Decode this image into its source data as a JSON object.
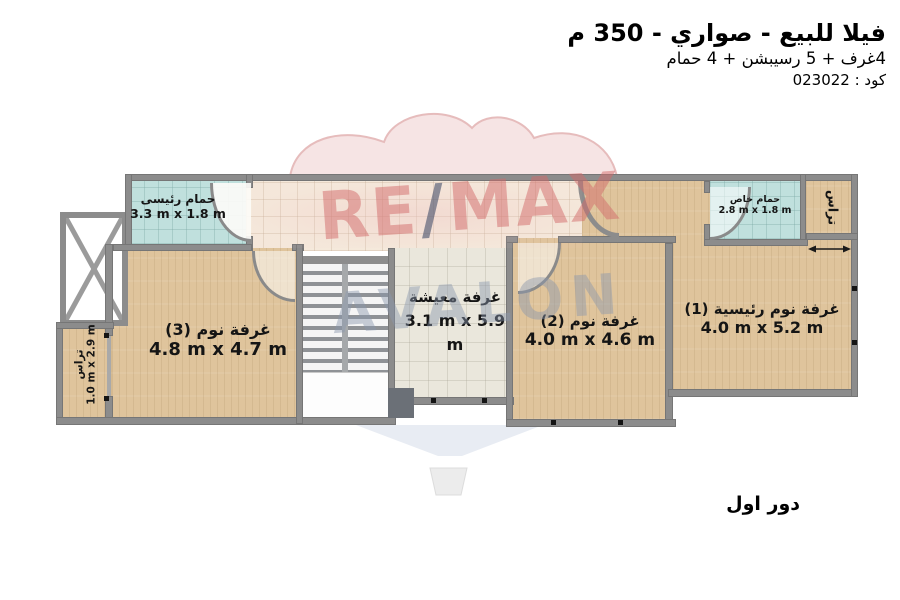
{
  "header": {
    "title": "فيلا للبيع - صواري - 350 م",
    "subtitle": "4غرف + 5 رسيبشن + 4 حمام",
    "code": "كود : 023022"
  },
  "floor_label": "دور اول",
  "watermark": {
    "re": "RE",
    "slash": "/",
    "max": "MAX",
    "name": "AVALON"
  },
  "rooms": {
    "main_bathroom": {
      "name": "حمام رئيسى",
      "dims": "3.3 m x 1.8 m"
    },
    "bedroom_3": {
      "name": "غرفة نوم (3)",
      "dims": "4.8 m x 4.7 m"
    },
    "living": {
      "name": "غرفة معيشة",
      "dims": "3.1 m x 5.9 m"
    },
    "bedroom_2": {
      "name": "غرفة نوم (2)",
      "dims": "4.0 m x 4.6 m"
    },
    "master_bedroom": {
      "name": "غرفة نوم رئيسية (1)",
      "dims": "4.0 m x 5.2 m"
    },
    "private_bathroom": {
      "name": "حمام خاص",
      "dims": "2.8 m x 1.8 m"
    },
    "terrace_left": {
      "name": "تراس",
      "dims": "1.0 m x 2.9 m"
    },
    "terrace_right": {
      "name": "تراس"
    }
  },
  "colors": {
    "wood": "#dfc49c",
    "hall_tile": "#f5e9db",
    "living_tile": "#eae7dc",
    "bathroom_teal": "#c0e0dd",
    "wall_gray": "#8c8c8c",
    "watermark_red": "#d26a6a",
    "watermark_slash_blue": "#344260",
    "watermark_gray_blue": "#8a96ad"
  }
}
